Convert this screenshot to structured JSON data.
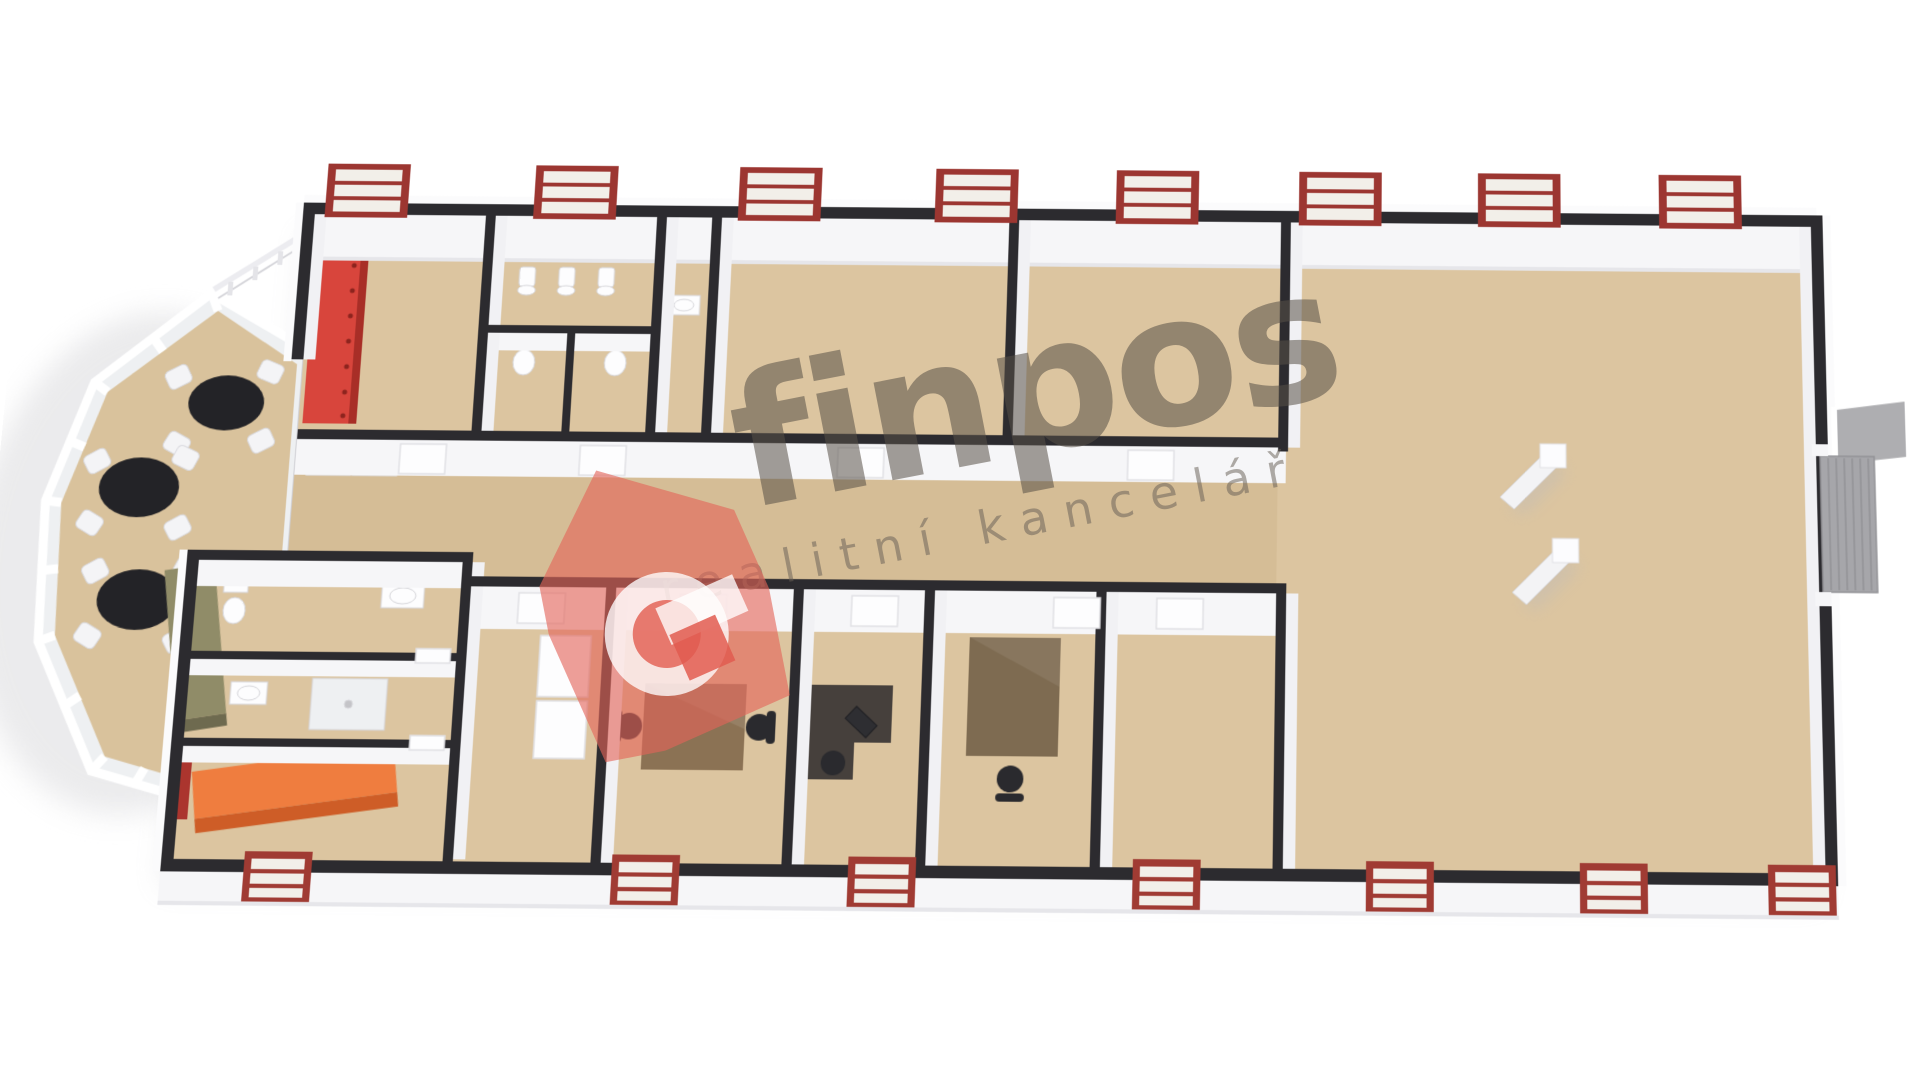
{
  "canvas": {
    "width": 1920,
    "height": 1080,
    "background": "#ffffff"
  },
  "watermark": {
    "brand": "finpos",
    "subtitle": "realitní kancelář",
    "logo": "house-with-g-icon",
    "brand_color": "rgba(88,80,71,0.55)",
    "subtitle_color": "rgba(104,96,87,0.52)",
    "logo_color": "rgba(228,100,88,0.62)",
    "rotation_deg": -11
  },
  "floor_plan": {
    "view": "3d-dollhouse-top-down",
    "palette": {
      "floor": "#dcc5a0",
      "corridor_floor": "#d3ba93",
      "wall_top": "#2c2b2f",
      "wall_face": "#f6f6f8",
      "window_frame_red": "#9c3631",
      "feature_shelving_red": "#d8453c",
      "counter_orange": "#ef7d3f",
      "counter_olive": "#908c68",
      "table_black": "#232327",
      "desk_brown": "#8b7254",
      "desk_dark": "#46403c",
      "door_gray": "#a6a6aa",
      "glass": "#eef0f2"
    },
    "elements": {
      "conservatory": {
        "shape": "octagonal-glass-winter-garden",
        "round_tables": 3,
        "chairs_per_table": 4,
        "railing": true
      },
      "top_rooms": [
        "cloakroom-with-red-shelving",
        "restroom-urinals",
        "toilet-stalls",
        "washroom-sink",
        "open-room-a",
        "open-room-b"
      ],
      "bottom_rooms": [
        "bathroom-toilet-sink",
        "shower-room",
        "reception-orange-counter",
        "lobby-with-closets",
        "office-double-desk",
        "office-corner-desk",
        "office-large-desk",
        "empty-room"
      ],
      "right_wing": {
        "open_hall": true,
        "support_columns": 2,
        "side_door": "gray-slatted-door",
        "loading_ramp": "gray"
      },
      "corridor": {
        "runs": "horizontal-center"
      },
      "windows": {
        "top_count": 8,
        "bottom_count": 7,
        "frame_color": "#9c3631"
      },
      "fixtures": [
        "urinal",
        "toilet",
        "sink",
        "shower-tray",
        "wardrobe-closet"
      ]
    }
  }
}
